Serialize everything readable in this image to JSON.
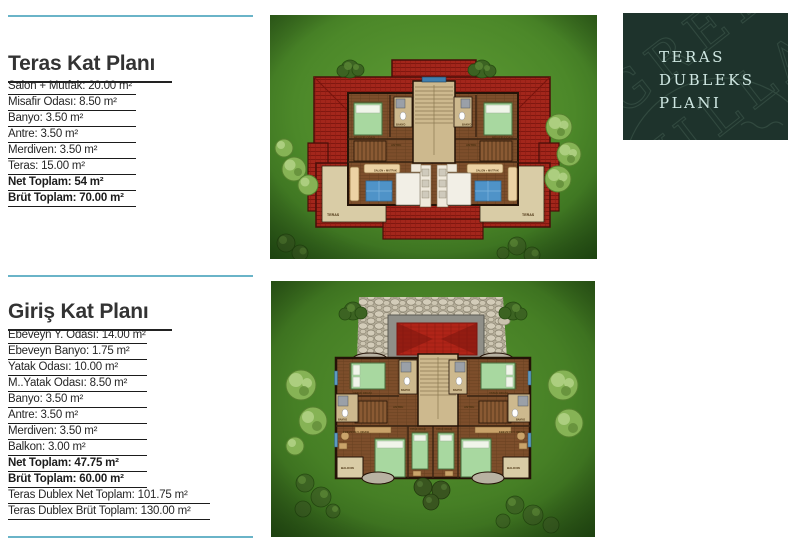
{
  "colors": {
    "rule_teal": "#6ab4c8",
    "text_dark": "#262626",
    "badge_bg": "#1e332c",
    "badge_text": "#cfe7e2",
    "lawn_green": "#4c8829",
    "roof_red": "#a3261b",
    "floor_brown": "#7d4e2b",
    "terrace_beige": "#d9cca6",
    "stair_beige": "#cdb98e",
    "bed_green": "#a8d8a0",
    "rug_blue": "#4f93c8"
  },
  "sections": [
    {
      "title": "Teras Kat Planı",
      "rows": [
        {
          "label": "Salon + Mutfak: 20.00 m²"
        },
        {
          "label": "Misafir Odası: 8.50 m²"
        },
        {
          "label": "Banyo: 3.50 m²"
        },
        {
          "label": "Antre: 3.50 m²"
        },
        {
          "label": "Merdiven: 3.50 m²"
        },
        {
          "label": "Teras: 15.00 m²"
        },
        {
          "label": "Net Toplam: 54 m²",
          "bold": true
        },
        {
          "label": "Brüt Toplam: 70.00 m²",
          "bold": true
        }
      ]
    },
    {
      "title": "Giriş Kat Planı",
      "rows": [
        {
          "label": "Ebeveyn Y. Odası: 14.00 m²"
        },
        {
          "label": "Ebeveyn Banyo: 1.75 m²"
        },
        {
          "label": "Yatak Odası: 10.00 m²"
        },
        {
          "label": "M..Yatak Odası: 8.50 m²"
        },
        {
          "label": "Banyo: 3.50 m²"
        },
        {
          "label": "Antre: 3.50 m²"
        },
        {
          "label": "Merdiven: 3.50 m²"
        },
        {
          "label": "Balkon: 3.00 m²"
        },
        {
          "label": "Net Toplam: 47.75 m²",
          "bold": true
        },
        {
          "label": "Brüt Toplam: 60.00 m²",
          "bold": true
        },
        {
          "label": "Teras Dublex Net Toplam: 101.75 m²",
          "wide": true
        },
        {
          "label": "Teras Dublex Brüt Toplam: 130.00 m²",
          "wide": true
        }
      ]
    }
  ],
  "badge": {
    "lines": [
      "TERAS",
      "DUBLEKS",
      "PLANI"
    ],
    "watermark": {
      "line1": "GREEN",
      "line2": "VILLA"
    }
  },
  "plans": {
    "terrace": {
      "labels": {
        "teras": "TERAS",
        "salon": "SALON + MUTFAK",
        "antre": "ANTRE",
        "banyo": "BANYO",
        "misafir": "MİSAFİR ODASI"
      }
    },
    "ground": {
      "labels": {
        "yatak": "YATAK ODASI",
        "banyo": "BANYO",
        "antre": "ANTRE",
        "ebeveyn": "EBEVEYN Y. ODASI",
        "balkon": "BALKON"
      }
    }
  }
}
